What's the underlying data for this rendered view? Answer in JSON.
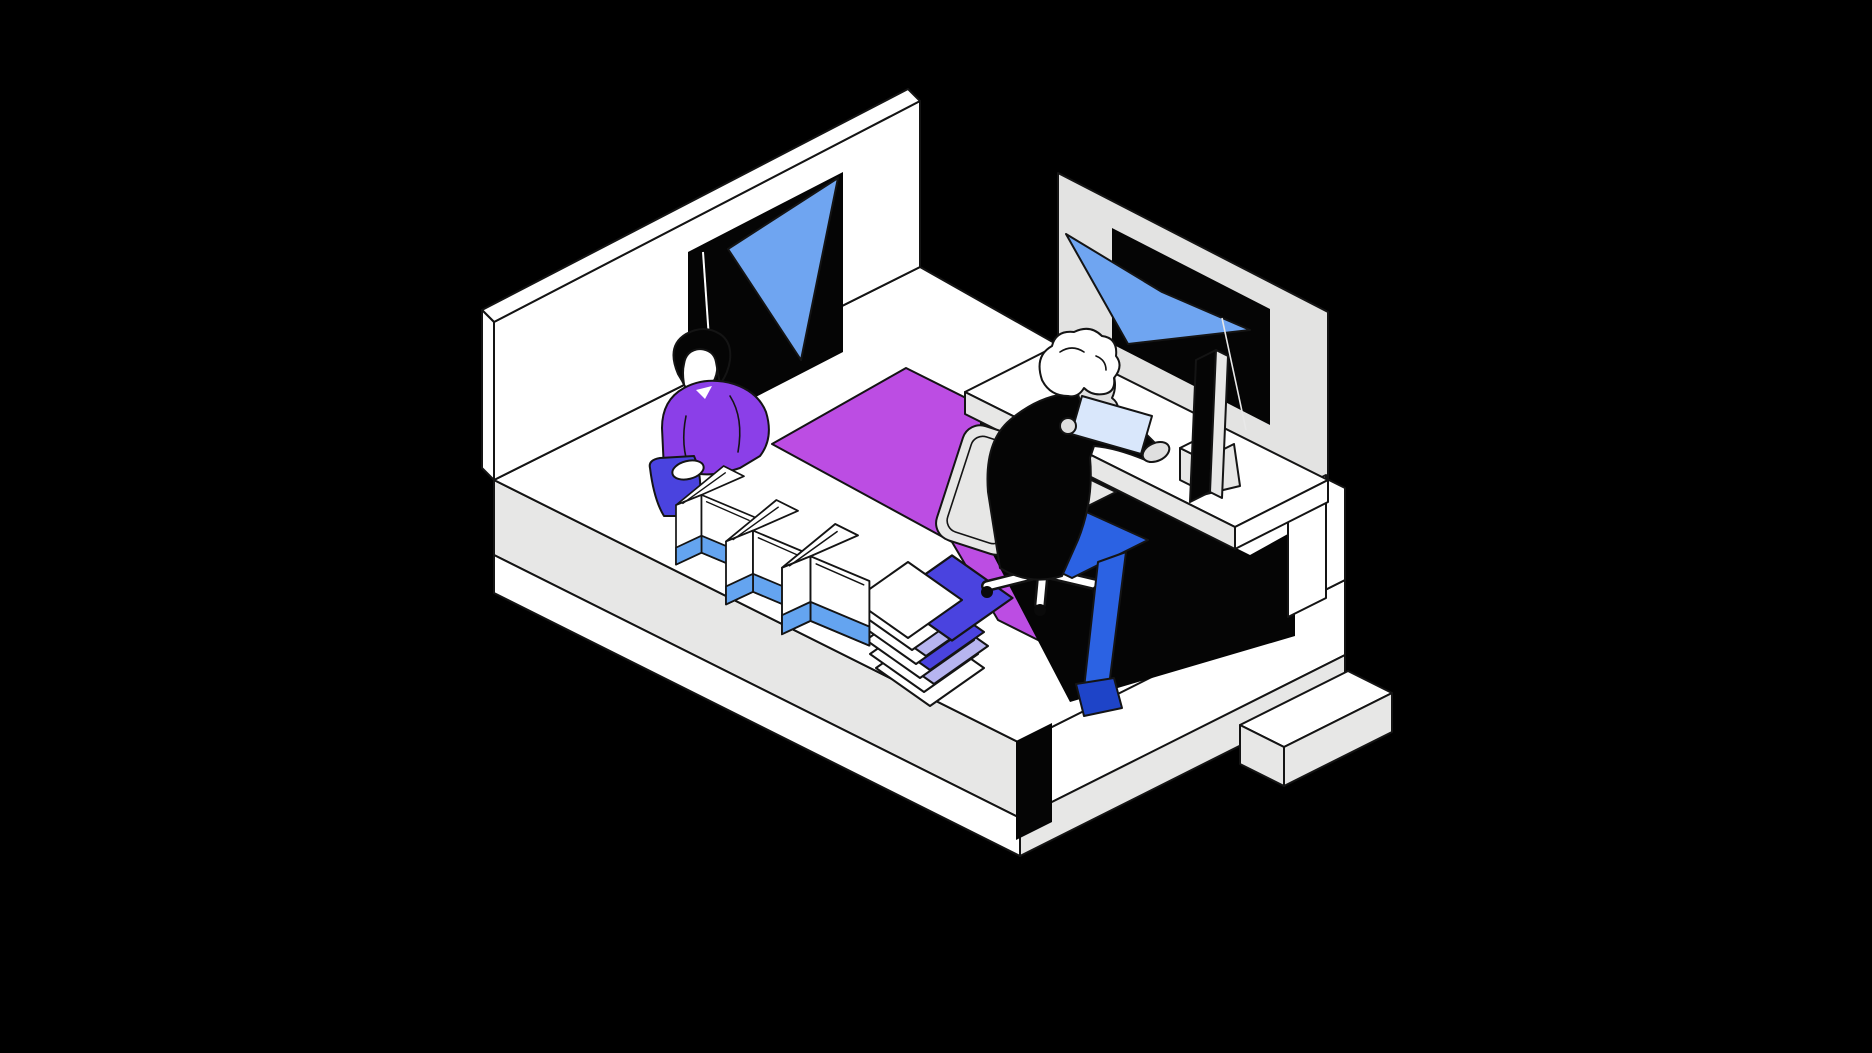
{
  "illustration": {
    "description": "Isometric office scene on black background",
    "objects": [
      "left wall with window, blue curtain and hanging cord",
      "standing person in purple sweater filling coffee bags with indigo scoop",
      "three white coffee bags with blue base bands",
      "stack of white sheets with indigo and lavender sheets",
      "magenta area rug",
      "office chair with star base and casters",
      "seated person in black sweater and blue pants reading a light blue page",
      "white desk with monitor, stand and small computer box",
      "gray partition wall with window and blue curtain",
      "layered platform base with dark corner notch and side step"
    ]
  },
  "palette": {
    "background": "#000000",
    "outline": "#141414",
    "white": "#ffffff",
    "surface_gray": "#e7e7e6",
    "panel_gray": "#e3e3e2",
    "ink_black": "#050505",
    "curtain_blue": "#6fa5f1",
    "band_blue": "#64a4f0",
    "indigo": "#4a43df",
    "lavender": "#b7b5f0",
    "rug_magenta": "#bc4de3",
    "sweater_purple": "#8b3fe8",
    "pants_blue": "#2b62e3",
    "shoe_navy": "#1e44c8",
    "paper_blue": "#d9e7fb",
    "face_gray": "#dfdfdf"
  }
}
